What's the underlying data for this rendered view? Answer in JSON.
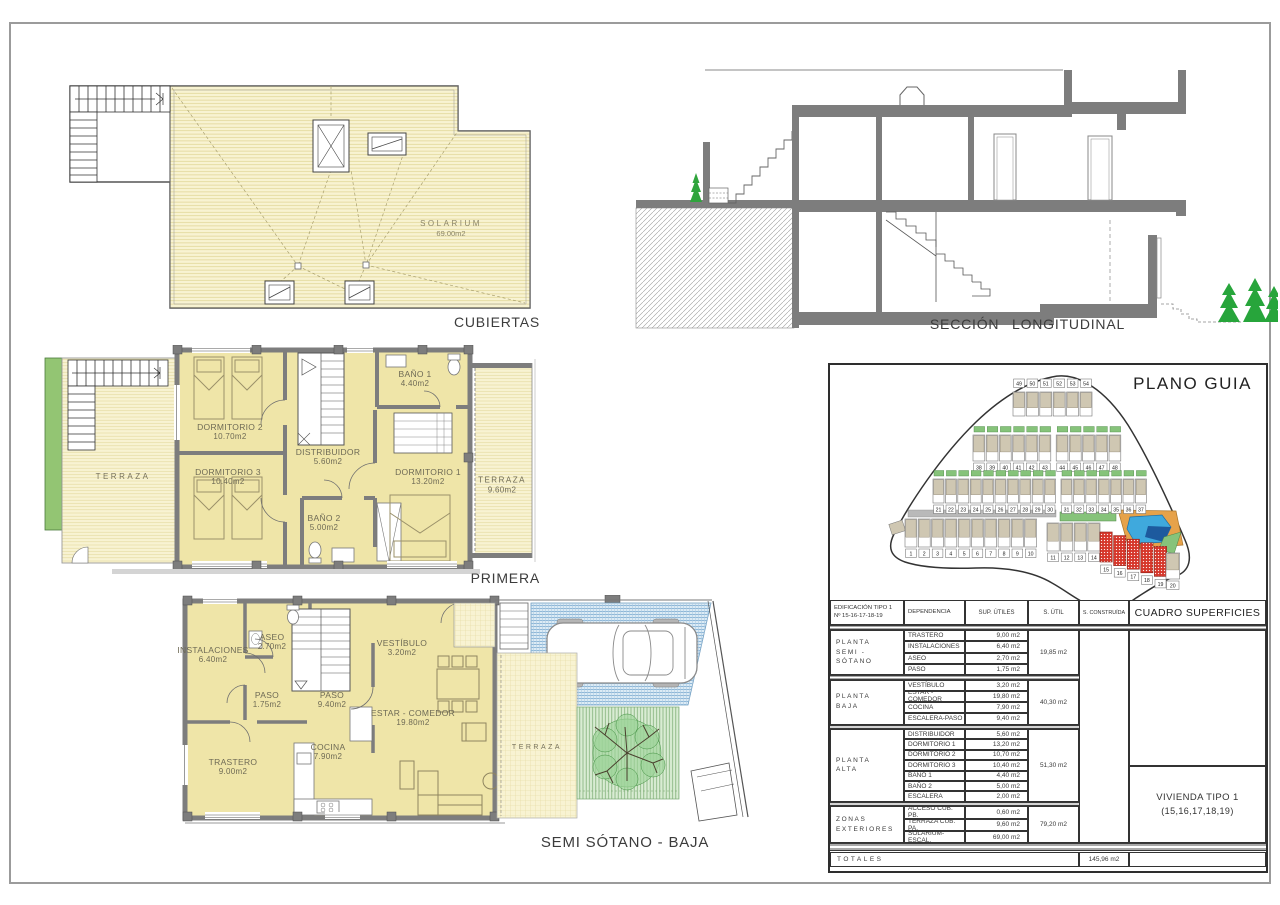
{
  "drawings": {
    "cubiertas": {
      "label": "CUBIERTAS",
      "solarium": {
        "name": "SOLARIUM",
        "area": "69.00m2"
      }
    },
    "seccion": {
      "label": "SECCIÓN  LONGITUDINAL"
    },
    "primera": {
      "label": "PRIMERA",
      "rooms": [
        {
          "name": "DORMITORIO 2",
          "area": "10.70m2"
        },
        {
          "name": "DORMITORIO 3",
          "area": "10.40m2"
        },
        {
          "name": "DISTRIBUIDOR",
          "area": "5.60m2"
        },
        {
          "name": "BAÑO 1",
          "area": "4.40m2"
        },
        {
          "name": "BAÑO 2",
          "area": "5.00m2"
        },
        {
          "name": "DORMITORIO 1",
          "area": "13.20m2"
        },
        {
          "name": "TERRAZA",
          "area": ""
        },
        {
          "name": "TERRAZA",
          "area": "9.60m2"
        }
      ]
    },
    "semisotano": {
      "label": "SEMI SÓTANO - BAJA",
      "rooms": [
        {
          "name": "INSTALACIONES",
          "area": "6.40m2"
        },
        {
          "name": "ASEO",
          "area": "2.70m2"
        },
        {
          "name": "PASO",
          "area": "1.75m2"
        },
        {
          "name": "PASO",
          "area": "9.40m2"
        },
        {
          "name": "VESTÍBULO",
          "area": "3.20m2"
        },
        {
          "name": "ESTAR - COMEDOR",
          "area": "19.80m2"
        },
        {
          "name": "COCINA",
          "area": "7.90m2"
        },
        {
          "name": "TRASTERO",
          "area": "9.00m2"
        },
        {
          "name": "TERRAZA",
          "area": ""
        }
      ]
    }
  },
  "plano_guia": {
    "title": "PLANO GUIA",
    "unit_rows": [
      {
        "units": [
          "49",
          "50",
          "51",
          "52",
          "53",
          "54"
        ]
      },
      {
        "units": [
          "38",
          "39",
          "40",
          "41",
          "42",
          "43",
          "44",
          "45",
          "46",
          "47",
          "48"
        ]
      },
      {
        "units": [
          "21",
          "22",
          "23",
          "24",
          "25",
          "26",
          "27",
          "28",
          "29",
          "30",
          "31",
          "32",
          "33",
          "34",
          "35",
          "36",
          "37"
        ]
      },
      {
        "units": [
          "1",
          "2",
          "3",
          "4",
          "5",
          "6",
          "7",
          "8",
          "9",
          "10"
        ]
      },
      {
        "units": [
          "11",
          "12",
          "13",
          "14"
        ]
      },
      {
        "units": [
          "15",
          "16",
          "17",
          "18",
          "19"
        ]
      },
      {
        "units": [
          "20"
        ]
      }
    ],
    "highlighted_units": [
      "15",
      "16",
      "17",
      "18",
      "19"
    ],
    "colors": {
      "highlight": "#d6372b",
      "house": "#cfc7b2",
      "garden": "#86c37a",
      "pool": "#3fa9dd",
      "pool_deck": "#e6a24a",
      "road": "#b9b9b9"
    }
  },
  "table": {
    "header": {
      "col1": "EDIFICACIÓN TIPO 1\nNº 15-16-17-18-19",
      "col2": "DEPENDENCIA",
      "col3": "SUP. ÚTILES",
      "col4": "S. ÚTIL",
      "col5": "S. CONSTRUÍDA",
      "col6": "CUADRO SUPERFICIES"
    },
    "groups": [
      {
        "name": "PLANTA\nSEMI - SÓTANO",
        "s_util": "19,85 m2",
        "rows": [
          [
            "TRASTERO",
            "9,00 m2"
          ],
          [
            "INSTALACIONES",
            "6,40 m2"
          ],
          [
            "ASEO",
            "2,70 m2"
          ],
          [
            "PASO",
            "1,75 m2"
          ]
        ]
      },
      {
        "name": "PLANTA\nBAJA",
        "s_util": "40,30 m2",
        "rows": [
          [
            "VESTÍBULO",
            "3,20 m2"
          ],
          [
            "ESTAR - COMEDOR",
            "19,80 m2"
          ],
          [
            "COCINA",
            "7,90 m2"
          ],
          [
            "ESCALERA-PASO",
            "9,40 m2"
          ]
        ]
      },
      {
        "name": "PLANTA\nALTA",
        "s_util": "51,30 m2",
        "rows": [
          [
            "DISTRIBUIDOR",
            "5,60 m2"
          ],
          [
            "DORMITORIO 1",
            "13,20 m2"
          ],
          [
            "DORMITORIO 2",
            "10,70 m2"
          ],
          [
            "DORMITORIO 3",
            "10,40 m2"
          ],
          [
            "BAÑO 1",
            "4,40 m2"
          ],
          [
            "BAÑO 2",
            "5,00 m2"
          ],
          [
            "ESCALERA",
            "2,00 m2"
          ]
        ]
      },
      {
        "name": "ZONAS\nEXTERIORES",
        "s_util": "79,20 m2",
        "rows": [
          [
            "ACCESO CUB. PB.",
            "0,60 m2"
          ],
          [
            "TERRAZA CUB. PA.",
            "9,60 m2"
          ],
          [
            "SOLARIUM-ESCAL.",
            "69,00 m2"
          ]
        ]
      }
    ],
    "totales_label": "TOTALES",
    "total_construida": "145,96 m2",
    "vivienda": {
      "line1": "VIVIENDA TIPO 1",
      "line2": "(15,16,17,18,19)"
    }
  }
}
